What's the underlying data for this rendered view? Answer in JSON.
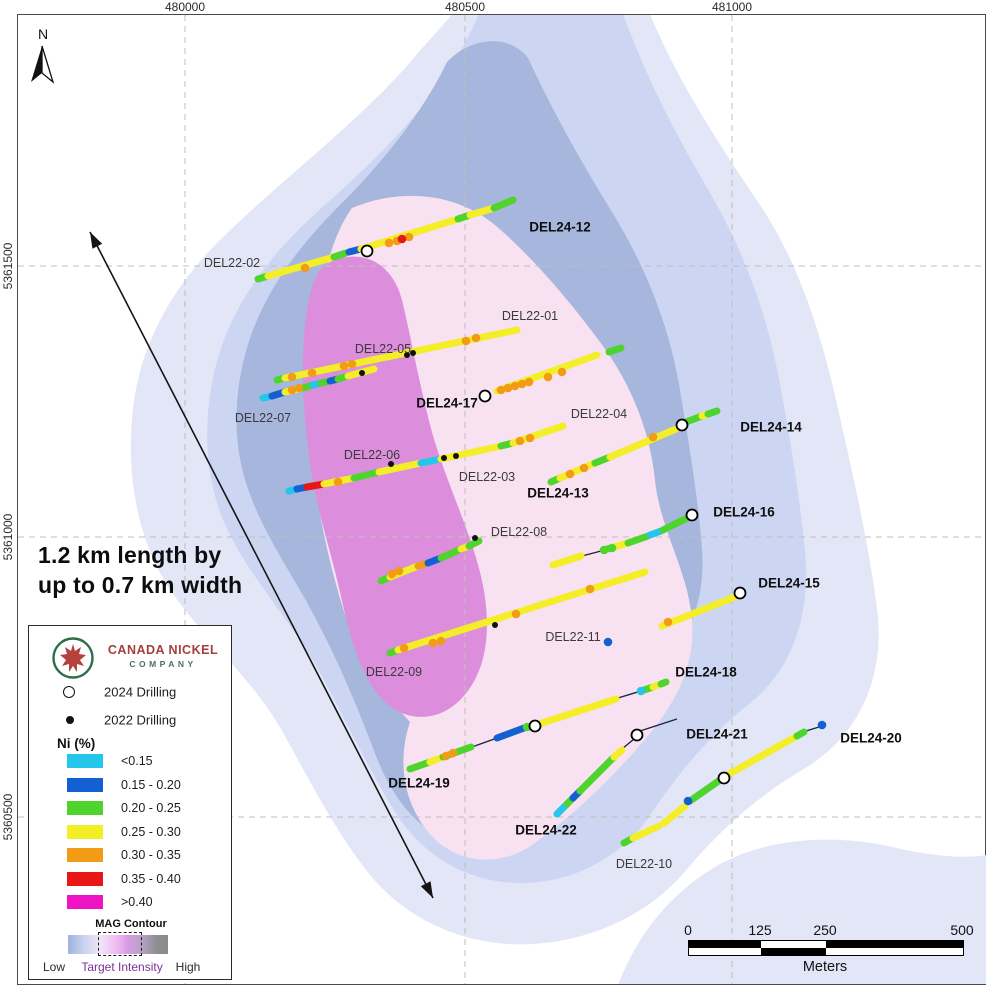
{
  "axis": {
    "x_ticks": [
      {
        "label": "480000",
        "x": 185
      },
      {
        "label": "480500",
        "x": 465
      },
      {
        "label": "481000",
        "x": 732
      }
    ],
    "y_ticks": [
      {
        "label": "5361500",
        "y": 266
      },
      {
        "label": "5361000",
        "y": 537
      },
      {
        "label": "5360500",
        "y": 817
      }
    ]
  },
  "north": {
    "label": "N"
  },
  "annotation": {
    "line1": "1.2 km length by",
    "line2": "up to 0.7 km width"
  },
  "measure_arrow": {
    "x1": 90,
    "y1": 232,
    "x2": 433,
    "y2": 898
  },
  "mag_layers": [
    {
      "name": "mag-contour-outer",
      "color": "#e2e6f7",
      "path": "M 452 14 L 650 14 C 676 78 716 140 760 205 C 798 262 820 330 836 400 C 852 470 868 540 877 608 C 886 678 858 738 802 770 C 758 796 720 830 688 868 C 654 910 598 940 534 944 C 470 948 406 922 367 871 C 334 829 309 779 281 729 C 251 677 204 639 171 591 C 138 542 127 479 132 419 C 137 350 170 289 221 239 C 281 180 361 120 412 60 C 428 41 442 27 452 14 Z"
    },
    {
      "name": "mag-contour-outer-southeast",
      "color": "#e2e6f7",
      "path": "M 618 985 C 636 938 666 898 710 870 C 760 838 832 833 892 847 C 930 856 964 859 987 855 L 987 985 Z"
    },
    {
      "name": "mag-contour-light",
      "color": "#ccd6f2",
      "path": "M 479 14 L 623 14 C 645 74 673 130 706 186 C 740 243 764 305 777 369 C 789 430 799 491 805 551 C 811 614 793 669 749 704 C 711 734 679 772 651 814 C 624 855 574 884 519 883 C 464 882 420 854 392 807 C 366 764 344 717 319 671 C 292 622 255 584 230 535 C 204 484 202 424 215 369 C 230 307 268 257 315 214 C 370 164 440 104 479 14 Z"
    },
    {
      "name": "mag-contour-mid",
      "color": "#a6b6dc",
      "path": "M 528 58 C 552 110 580 160 612 212 C 644 264 668 322 679 384 C 688 438 698 496 702 549 C 706 604 686 649 649 679 C 614 707 589 744 567 787 C 544 831 505 854 461 844 C 419 834 393 799 376 756 C 359 711 341 667 319 625 C 296 579 269 544 251 497 C 231 447 233 391 249 341 C 267 287 301 244 341 204 C 386 159 424 110 447 62 C 472 36 510 34 528 58 Z"
    },
    {
      "name": "mag-contour-target",
      "color": "#f8e2f2",
      "path": "M 352 208 C 400 188 455 192 495 225 C 530 255 566 296 600 342 C 630 382 650 430 655 480 C 660 530 688 570 692 620 C 696 668 672 710 640 745 C 608 782 570 818 532 845 C 495 870 450 862 425 828 C 402 797 398 758 410 722 C 380 690 355 650 342 605 C 326 552 315 498 312 445 C 308 378 315 258 352 208 Z"
    },
    {
      "name": "mag-contour-core",
      "color": "#dc8edd",
      "path": "M 330 262 C 362 248 392 262 402 300 C 412 342 420 388 432 432 C 446 482 468 525 480 572 C 492 620 490 668 462 698 C 436 726 398 722 376 692 C 356 664 348 628 340 592 C 330 548 316 508 310 462 C 302 408 300 345 308 305 C 312 282 318 268 330 262 Z"
    }
  ],
  "assay_colors": {
    "cyan": "#24c6e9",
    "blue": "#1360d2",
    "green": "#4ed42d",
    "yellow": "#f3ee27",
    "orange": "#f29c15",
    "red": "#e81616",
    "magenta": "#ee14c4"
  },
  "trace_segments": [
    [
      258,
      279,
      268,
      276,
      "green"
    ],
    [
      268,
      276,
      334,
      257,
      "yellow"
    ],
    [
      334,
      257,
      346,
      253,
      "green"
    ],
    [
      349,
      252,
      361,
      249,
      "blue"
    ],
    [
      361,
      249,
      458,
      219,
      "yellow"
    ],
    [
      458,
      219,
      470,
      215,
      "green"
    ],
    [
      470,
      215,
      494,
      208,
      "yellow"
    ],
    [
      494,
      208,
      513,
      200,
      "green"
    ],
    [
      277,
      380,
      285,
      378,
      "green"
    ],
    [
      285,
      378,
      517,
      330,
      "yellow"
    ],
    [
      263,
      398,
      272,
      396,
      "cyan"
    ],
    [
      272,
      396,
      285,
      392,
      "blue"
    ],
    [
      285,
      392,
      303,
      388,
      "yellow"
    ],
    [
      303,
      388,
      313,
      385,
      "green"
    ],
    [
      313,
      385,
      321,
      383,
      "cyan"
    ],
    [
      321,
      383,
      330,
      381,
      "green"
    ],
    [
      330,
      381,
      338,
      379,
      "blue"
    ],
    [
      338,
      379,
      348,
      376,
      "green"
    ],
    [
      348,
      376,
      374,
      369,
      "yellow"
    ],
    [
      289,
      491,
      297,
      489,
      "cyan"
    ],
    [
      297,
      489,
      307,
      487,
      "blue"
    ],
    [
      307,
      487,
      324,
      484,
      "red"
    ],
    [
      324,
      484,
      354,
      478,
      "yellow"
    ],
    [
      354,
      478,
      379,
      472,
      "green"
    ],
    [
      379,
      472,
      421,
      463,
      "yellow"
    ],
    [
      421,
      463,
      441,
      459,
      "cyan"
    ],
    [
      441,
      459,
      501,
      446,
      "yellow"
    ],
    [
      501,
      446,
      513,
      443,
      "green"
    ],
    [
      513,
      443,
      563,
      426,
      "yellow"
    ],
    [
      497,
      391,
      597,
      355,
      "yellow"
    ],
    [
      609,
      352,
      621,
      348,
      "green"
    ],
    [
      551,
      482,
      560,
      478,
      "green"
    ],
    [
      560,
      478,
      595,
      463,
      "yellow"
    ],
    [
      595,
      463,
      610,
      457,
      "green"
    ],
    [
      610,
      457,
      676,
      429,
      "yellow"
    ],
    [
      686,
      422,
      702,
      416,
      "green"
    ],
    [
      702,
      416,
      708,
      414,
      "yellow"
    ],
    [
      708,
      414,
      717,
      411,
      "green"
    ],
    [
      553,
      565,
      581,
      556,
      "yellow"
    ],
    [
      604,
      550,
      614,
      547,
      "green"
    ],
    [
      614,
      547,
      628,
      543,
      "yellow"
    ],
    [
      628,
      543,
      648,
      536,
      "green"
    ],
    [
      650,
      535,
      661,
      531,
      "cyan"
    ],
    [
      663,
      530,
      687,
      518,
      "green"
    ],
    [
      381,
      581,
      390,
      577,
      "green"
    ],
    [
      390,
      577,
      418,
      566,
      "yellow"
    ],
    [
      418,
      566,
      428,
      563,
      "orange"
    ],
    [
      428,
      563,
      441,
      558,
      "blue"
    ],
    [
      441,
      558,
      461,
      549,
      "green"
    ],
    [
      461,
      549,
      469,
      546,
      "yellow"
    ],
    [
      469,
      546,
      479,
      541,
      "green"
    ],
    [
      390,
      653,
      398,
      650,
      "green"
    ],
    [
      398,
      650,
      645,
      572,
      "yellow"
    ],
    [
      662,
      626,
      737,
      596,
      "yellow"
    ],
    [
      410,
      769,
      430,
      762,
      "green"
    ],
    [
      430,
      762,
      443,
      757,
      "yellow"
    ],
    [
      443,
      757,
      471,
      747,
      "green"
    ],
    [
      497,
      738,
      524,
      728,
      "blue"
    ],
    [
      542,
      723,
      616,
      699,
      "yellow"
    ],
    [
      644,
      690,
      653,
      687,
      "green"
    ],
    [
      653,
      687,
      661,
      684,
      "yellow"
    ],
    [
      661,
      684,
      666,
      682,
      "green"
    ],
    [
      557,
      814,
      567,
      804,
      "cyan"
    ],
    [
      567,
      804,
      573,
      798,
      "green"
    ],
    [
      573,
      798,
      580,
      791,
      "blue"
    ],
    [
      580,
      791,
      614,
      757,
      "green"
    ],
    [
      614,
      757,
      622,
      750,
      "yellow"
    ],
    [
      624,
      843,
      633,
      838,
      "green"
    ],
    [
      633,
      838,
      659,
      826,
      "yellow"
    ],
    [
      664,
      823,
      685,
      806,
      "yellow"
    ],
    [
      690,
      801,
      720,
      780,
      "green"
    ],
    [
      729,
      774,
      797,
      736,
      "yellow"
    ],
    [
      797,
      736,
      804,
      732,
      "green"
    ]
  ],
  "thin_lines": [
    [
      472,
      747,
      497,
      738
    ],
    [
      618,
      698,
      641,
      691
    ],
    [
      582,
      556,
      601,
      551
    ],
    [
      622,
      749,
      634,
      739
    ],
    [
      640,
      731,
      677,
      719
    ],
    [
      806,
      731,
      819,
      727
    ],
    [
      595,
      588,
      608,
      584
    ]
  ],
  "assay_dots": [
    [
      305,
      268,
      "orange"
    ],
    [
      389,
      243,
      "orange"
    ],
    [
      397,
      241,
      "orange"
    ],
    [
      409,
      237,
      "orange"
    ],
    [
      402,
      239,
      "red"
    ],
    [
      292,
      377,
      "orange"
    ],
    [
      312,
      373,
      "orange"
    ],
    [
      344,
      366,
      "orange"
    ],
    [
      352,
      364,
      "orange"
    ],
    [
      466,
      341,
      "orange"
    ],
    [
      476,
      338,
      "orange"
    ],
    [
      292,
      390,
      "orange"
    ],
    [
      299,
      388,
      "orange"
    ],
    [
      338,
      482,
      "orange"
    ],
    [
      520,
      441,
      "orange"
    ],
    [
      530,
      438,
      "orange"
    ],
    [
      501,
      390,
      "orange"
    ],
    [
      508,
      388,
      "orange"
    ],
    [
      515,
      386,
      "orange"
    ],
    [
      522,
      384,
      "orange"
    ],
    [
      529,
      382,
      "orange"
    ],
    [
      548,
      377,
      "orange"
    ],
    [
      562,
      372,
      "orange"
    ],
    [
      570,
      474,
      "orange"
    ],
    [
      584,
      468,
      "orange"
    ],
    [
      653,
      437,
      "orange"
    ],
    [
      392,
      574,
      "orange"
    ],
    [
      399,
      571,
      "orange"
    ],
    [
      404,
      648,
      "orange"
    ],
    [
      433,
      643,
      "orange"
    ],
    [
      441,
      641,
      "orange"
    ],
    [
      516,
      614,
      "orange"
    ],
    [
      590,
      589,
      "orange"
    ],
    [
      668,
      622,
      "orange"
    ],
    [
      446,
      756,
      "orange"
    ],
    [
      453,
      753,
      "orange"
    ],
    [
      604,
      550,
      "green"
    ],
    [
      612,
      548,
      "green"
    ],
    [
      527,
      727,
      "green"
    ],
    [
      608,
      642,
      "blue"
    ],
    [
      822,
      725,
      "blue"
    ],
    [
      688,
      801,
      "blue"
    ],
    [
      641,
      691,
      "cyan"
    ]
  ],
  "collars_2022": [
    [
      407,
      355
    ],
    [
      413,
      353
    ],
    [
      362,
      373
    ],
    [
      391,
      464
    ],
    [
      444,
      458
    ],
    [
      456,
      456
    ],
    [
      475,
      538
    ],
    [
      495,
      625
    ]
  ],
  "collars_2024": [
    [
      367,
      251
    ],
    [
      485,
      396
    ],
    [
      682,
      425
    ],
    [
      692,
      515
    ],
    [
      740,
      593
    ],
    [
      535,
      726
    ],
    [
      637,
      735
    ],
    [
      724,
      778
    ]
  ],
  "hole_labels": [
    {
      "text": "DEL22-02",
      "x": 232,
      "y": 263,
      "bold": false
    },
    {
      "text": "DEL24-12",
      "x": 560,
      "y": 227,
      "bold": true
    },
    {
      "text": "DEL22-01",
      "x": 530,
      "y": 316,
      "bold": false
    },
    {
      "text": "DEL22-05",
      "x": 383,
      "y": 349,
      "bold": false
    },
    {
      "text": "DEL24-17",
      "x": 447,
      "y": 403,
      "bold": true
    },
    {
      "text": "DEL22-07",
      "x": 263,
      "y": 418,
      "bold": false
    },
    {
      "text": "DEL22-04",
      "x": 599,
      "y": 414,
      "bold": false
    },
    {
      "text": "DEL24-14",
      "x": 771,
      "y": 427,
      "bold": true
    },
    {
      "text": "DEL22-06",
      "x": 372,
      "y": 455,
      "bold": false
    },
    {
      "text": "DEL22-03",
      "x": 487,
      "y": 477,
      "bold": false
    },
    {
      "text": "DEL24-13",
      "x": 558,
      "y": 493,
      "bold": true
    },
    {
      "text": "DEL24-16",
      "x": 744,
      "y": 512,
      "bold": true
    },
    {
      "text": "DEL22-08",
      "x": 519,
      "y": 532,
      "bold": false
    },
    {
      "text": "DEL24-15",
      "x": 789,
      "y": 583,
      "bold": true
    },
    {
      "text": "DEL22-11",
      "x": 573,
      "y": 637,
      "bold": false
    },
    {
      "text": "DEL22-09",
      "x": 394,
      "y": 672,
      "bold": false
    },
    {
      "text": "DEL24-18",
      "x": 706,
      "y": 672,
      "bold": true
    },
    {
      "text": "DEL24-21",
      "x": 717,
      "y": 734,
      "bold": true
    },
    {
      "text": "DEL24-20",
      "x": 871,
      "y": 738,
      "bold": true
    },
    {
      "text": "DEL24-19",
      "x": 419,
      "y": 783,
      "bold": true
    },
    {
      "text": "DEL24-22",
      "x": 546,
      "y": 830,
      "bold": true
    },
    {
      "text": "DEL22-10",
      "x": 644,
      "y": 864,
      "bold": false
    }
  ],
  "legend": {
    "brand_line1": "CANADA NICKEL",
    "brand_line2": "COMPANY",
    "drilling_2024": "2024 Drilling",
    "drilling_2022": "2022 Drilling",
    "ni_title": "Ni (%)",
    "ni_classes": [
      {
        "color": "#24c6e9",
        "label": "<0.15"
      },
      {
        "color": "#1360d2",
        "label": "0.15 - 0.20"
      },
      {
        "color": "#4ed42d",
        "label": "0.20 - 0.25"
      },
      {
        "color": "#f3ee27",
        "label": "0.25 - 0.30"
      },
      {
        "color": "#f29c15",
        "label": "0.30 - 0.35"
      },
      {
        "color": "#e81616",
        "label": "0.35 - 0.40"
      },
      {
        "color": "#ee14c4",
        "label": ">0.40"
      }
    ],
    "mag_title": "MAG Contour",
    "mag_low": "Low",
    "mag_mid": "Target Intensity",
    "mag_high": "High"
  },
  "scalebar": {
    "ticks": [
      {
        "label": "0",
        "x": 0
      },
      {
        "label": "125",
        "x": 72
      },
      {
        "label": "250",
        "x": 137
      },
      {
        "label": "500",
        "x": 274
      }
    ],
    "unit": "Meters"
  }
}
